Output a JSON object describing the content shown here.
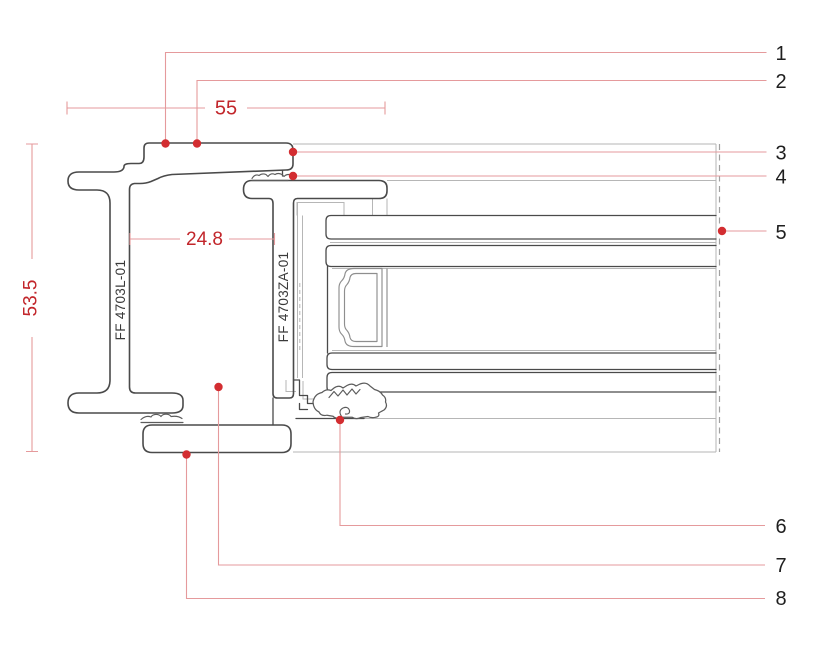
{
  "drawing": {
    "type": "profile-section",
    "dimensions": {
      "overall_width": "55",
      "frame_cavity": "24.8",
      "overall_height": "53.5"
    },
    "profiles": {
      "frame_label": "FF 4703L-01",
      "sash_label": "FF 4703ZA-01"
    },
    "callouts": [
      {
        "label": "1"
      },
      {
        "label": "2"
      },
      {
        "label": "3"
      },
      {
        "label": "4"
      },
      {
        "label": "5"
      },
      {
        "label": "6"
      },
      {
        "label": "7"
      },
      {
        "label": "8"
      }
    ],
    "colors": {
      "outline-dark": "#4a4a4a",
      "outline-soft": "#5c5c5c",
      "line-medium": "#8e8e8e",
      "line-light": "#b6b6b6",
      "dash-gray": "#a0a0a0",
      "dim-red": "#c2262b",
      "leader-red": "#e59a9c",
      "dot-red": "#d32d31",
      "callout-text": "#1f1f1f",
      "label-text": "#3a3a3a"
    }
  }
}
